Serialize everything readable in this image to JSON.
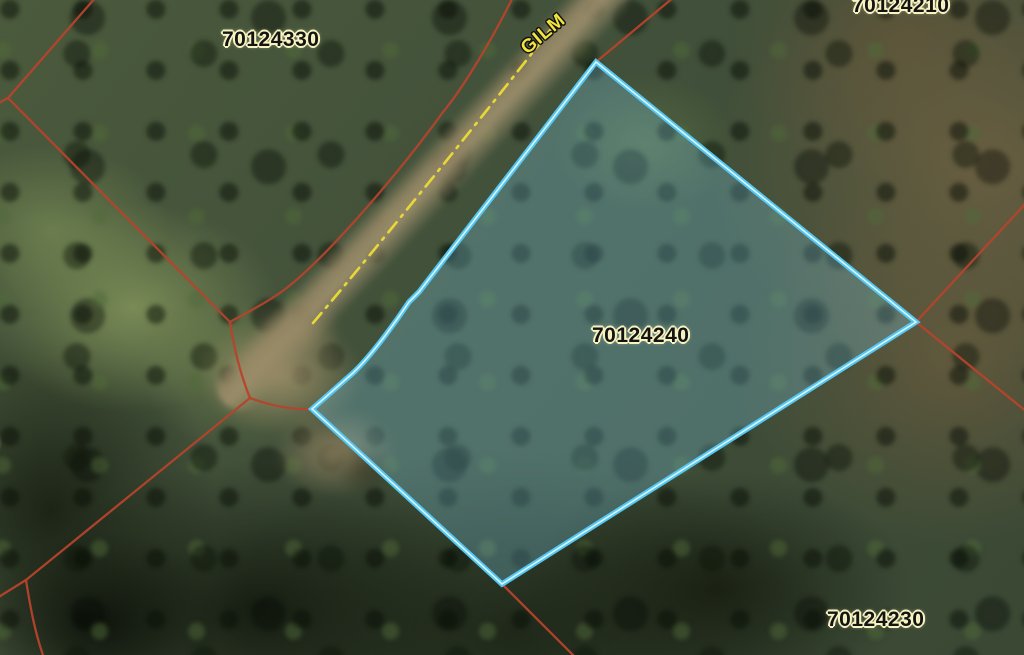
{
  "map": {
    "parcels": {
      "labels": [
        {
          "text": "70124330"
        },
        {
          "text": "70124210"
        },
        {
          "text": "70124240"
        },
        {
          "text": "70124230"
        },
        {
          "text": "0"
        }
      ],
      "selected_id": "70124240"
    },
    "road": {
      "name_label": "GILM"
    },
    "colors": {
      "boundary_line": "#b5432c",
      "selected_outline": "#54c7f0",
      "selected_inner_glow": "#e8f8ff",
      "road_centerline": "#e8d837",
      "label_text": "#141414",
      "label_halo": "#f8f4c2",
      "road_label": "#f2e43c"
    }
  }
}
